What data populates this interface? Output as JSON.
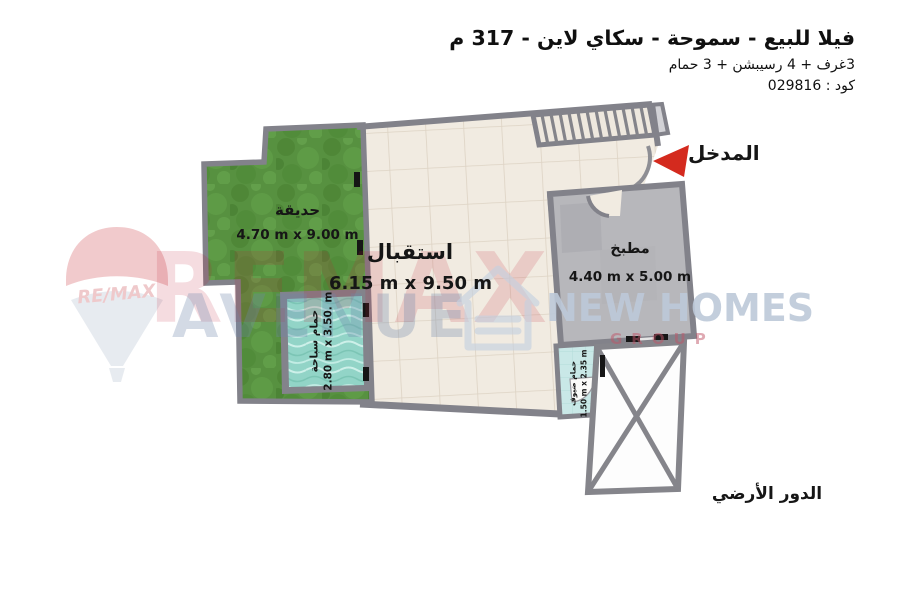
{
  "header": {
    "title": "فيلا للبيع - سموحة - سكاي لاين - 317 م",
    "subtitle": "3غرف + 4 رسيبشن + 3 حمام",
    "code_line": "كود : 029816"
  },
  "plan": {
    "floor_label": "الدور الأرضي",
    "entrance_label": "المدخل",
    "rooms": {
      "garden": {
        "name": "حديقة",
        "dims": "4.70 m x 9.00 m"
      },
      "reception": {
        "name": "استقبال",
        "dims": "6.15 m x 9.50 m"
      },
      "kitchen": {
        "name": "مطبخ",
        "dims": "4.40 m x 5.00 m"
      },
      "pool": {
        "name": "حمام سباحة",
        "dims": "2.80 m x 3.50. m"
      },
      "guest_bathroom": {
        "name": "حمام ضيوف",
        "dims": "1.50 m x 2.35 m"
      }
    }
  },
  "watermarks": {
    "balloon_brand": "RE/MAX",
    "brand_line1": "REMAX",
    "brand_line2": "AVENUE",
    "agency_name": "NEW HOMES",
    "agency_sub": "GROUP"
  },
  "colors": {
    "wall_gray": "#82828a",
    "floor_beige": "#f1ebe1",
    "garden_green": "#579140",
    "kitchen_gray": "#b7b7bb",
    "pool_teal": "#92d4c7",
    "bath_teal": "#c9e8e7",
    "entrance_arrow_red": "#d42a1e",
    "brand_red": "#c21f35",
    "brand_blue_gray": "#6f87ac"
  }
}
